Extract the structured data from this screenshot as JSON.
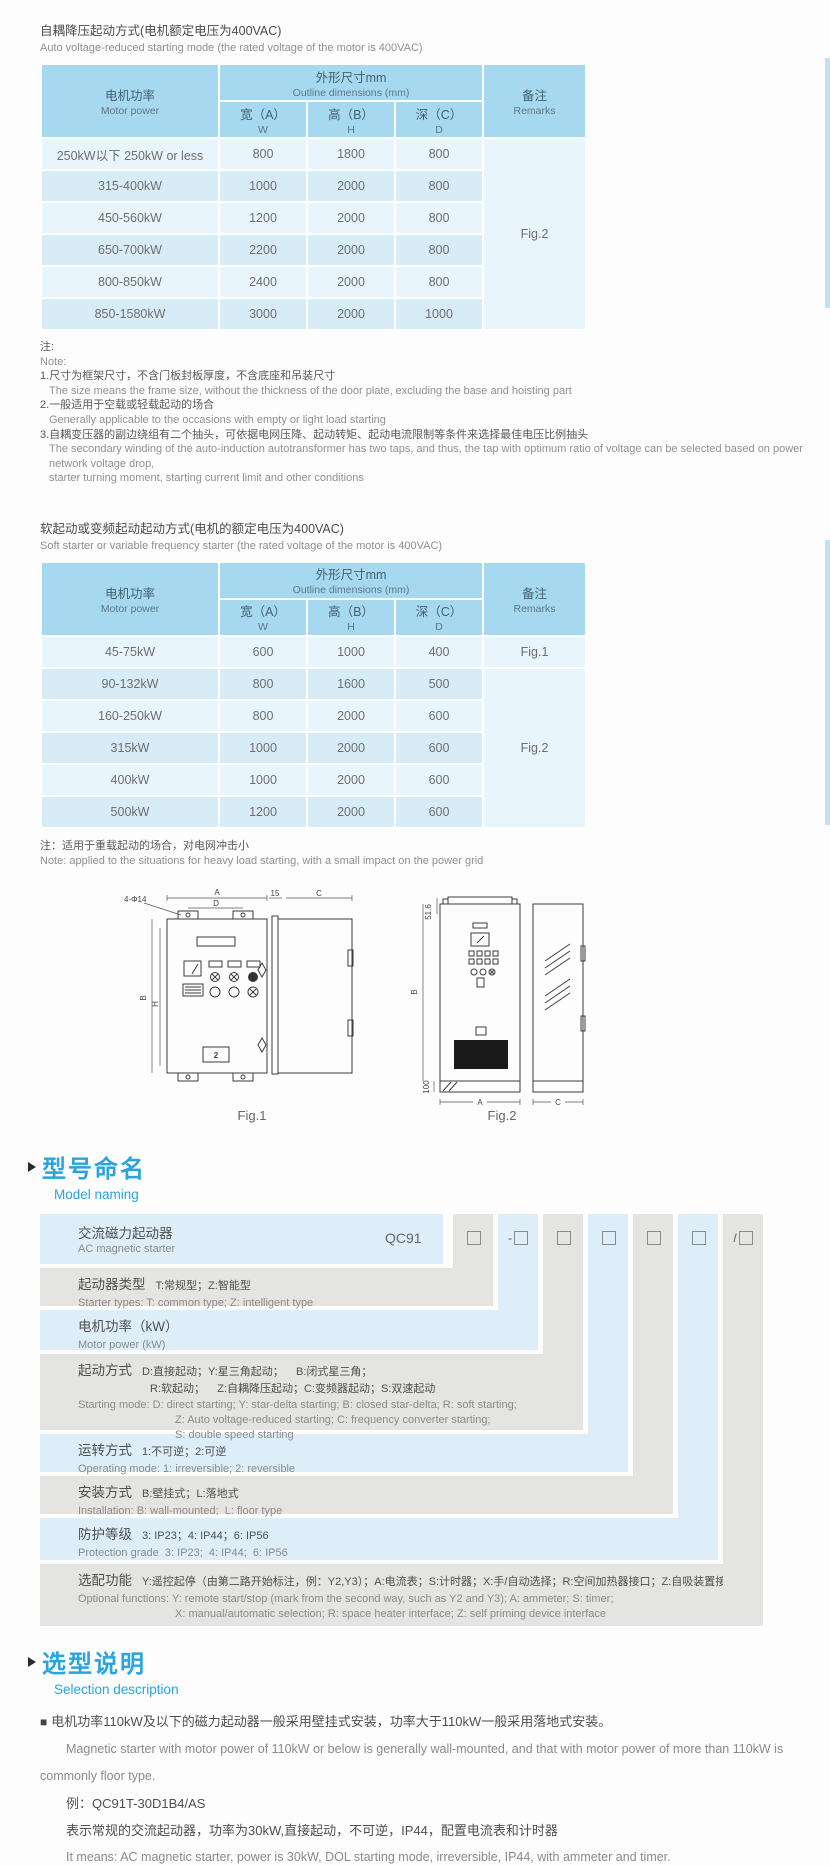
{
  "table_header": {
    "motor_cn": "电机功率",
    "motor_en": "Motor power",
    "outline_cn": "外形尺寸mm",
    "outline_en": "Outline dimensions (mm)",
    "w_cn": "宽（A）",
    "w_en": "W",
    "h_cn": "高（B）",
    "h_en": "H",
    "d_cn": "深（C）",
    "d_en": "D",
    "remarks_cn": "备注",
    "remarks_en": "Remarks"
  },
  "section_auto": {
    "title_cn": "自耦降压起动方式(电机额定电压为400VAC)",
    "title_en": "Auto voltage-reduced starting mode (the rated voltage of the motor is 400VAC)",
    "table": {
      "rows": [
        {
          "power": "250kW以下 250kW or less",
          "w": "800",
          "h": "1800",
          "d": "800"
        },
        {
          "power": "315-400kW",
          "w": "1000",
          "h": "2000",
          "d": "800"
        },
        {
          "power": "450-560kW",
          "w": "1200",
          "h": "2000",
          "d": "800"
        },
        {
          "power": "650-700kW",
          "w": "2200",
          "h": "2000",
          "d": "800"
        },
        {
          "power": "800-850kW",
          "w": "2400",
          "h": "2000",
          "d": "800"
        },
        {
          "power": "850-1580kW",
          "w": "3000",
          "h": "2000",
          "d": "1000"
        }
      ],
      "remark": "Fig.2"
    },
    "notes": [
      "注:",
      "Note:",
      "1.尺寸为框架尺寸，不含门板封板厚度，不含底座和吊装尺寸",
      "The size means the frame size, without the thickness of the door plate, excluding the base and hoisting part",
      "2.一般适用于空载或轻载起动的场合",
      "Generally applicable to the occasions with empty or light load starting",
      "3.自耦变压器的副边绕组有二个抽头，可依据电网压降、起动转矩、起动电流限制等条件来选择最佳电压比例抽头",
      "The secondary winding of the auto-induction autotransformer has two taps, and thus, the tap with optimum ratio of voltage can be selected based on power network voltage drop,",
      "starter turning moment, starting current limit and other conditions"
    ]
  },
  "section_soft": {
    "title_cn": "软起动或变频起动起动方式(电机的额定电压为400VAC)",
    "title_en": "Soft starter or variable frequency starter (the rated voltage of the motor is 400VAC)",
    "table": {
      "rows": [
        {
          "power": "45-75kW",
          "w": "600",
          "h": "1000",
          "d": "400"
        },
        {
          "power": "90-132kW",
          "w": "800",
          "h": "1600",
          "d": "500"
        },
        {
          "power": "160-250kW",
          "w": "800",
          "h": "2000",
          "d": "600"
        },
        {
          "power": "315kW",
          "w": "1000",
          "h": "2000",
          "d": "600"
        },
        {
          "power": "400kW",
          "w": "1000",
          "h": "2000",
          "d": "600"
        },
        {
          "power": "500kW",
          "w": "1200",
          "h": "2000",
          "d": "600"
        }
      ],
      "remark_first": "Fig.1",
      "remark_rest": "Fig.2"
    },
    "note_cn": "注：适用于重载起动的场合，对电网冲击小",
    "note_en": "Note: applied to the situations for heavy load starting, with a small impact on the power grid"
  },
  "figures": {
    "fig1": {
      "caption": "Fig.1",
      "dim_a": "A",
      "dim_d": "D",
      "dim_b": "B",
      "dim_h": "H",
      "holes": "4-Φ14",
      "side_offset": "15",
      "side_depth": "C",
      "panel_num": "2"
    },
    "fig2": {
      "caption": "Fig.2",
      "dim_top": "51.6",
      "dim_b": "B",
      "dim_base": "100",
      "dim_a": "A",
      "dim_c": "C"
    }
  },
  "model_naming": {
    "heading_cn": "型号命名",
    "heading_en": "Model naming",
    "product_cn": "交流磁力起动器",
    "product_en": "AC magnetic starter",
    "code": "QC91",
    "boxes": [
      {
        "prefix": ""
      },
      {
        "prefix": "-"
      },
      {
        "prefix": ""
      },
      {
        "prefix": ""
      },
      {
        "prefix": ""
      },
      {
        "prefix": ""
      },
      {
        "prefix": "/"
      }
    ],
    "rows": [
      {
        "label": "起动器类型",
        "cn": "T:常规型；Z:智能型",
        "en1": "Starter types: T: common type; Z: intelligent type"
      },
      {
        "label": "电机功率（kW）",
        "en1": "Motor power (kW)"
      },
      {
        "label": "起动方式",
        "cn": "D:直接起动；Y:星三角起动；    B:闭式星三角；",
        "cn2": "R:软起动；    Z:自耦降压起动；C:变频器起动；S:双速起动",
        "en1": "Starting mode: D: direct starting; Y: star-delta starting; B: closed star-delta; R: soft starting;",
        "en2": "Z: Auto voltage-reduced starting; C: frequency converter starting;",
        "en3": "S: double speed starting"
      },
      {
        "label": "运转方式",
        "cn": "1:不可逆；2:可逆",
        "en1": "Operating mode: 1: irreversible; 2: reversible"
      },
      {
        "label": "安装方式",
        "cn": "B:壁挂式；L:落地式",
        "en1": "Installation: B: wall-mounted;  L: floor type"
      },
      {
        "label": "防护等级",
        "cn": "3: IP23；4: IP44；6: IP56",
        "en1": "Protection grade  3: IP23;  4: IP44;  6: IP56"
      },
      {
        "label": "选配功能",
        "cn": "Y:遥控起停（由第二路开始标注，例：Y2,Y3）；A:电流表；S:计时器；X:手/自动选择；R:空间加热器接口；Z:自吸装置接口",
        "en1": "Optional functions: Y: remote start/stop (mark from the second way, such as Y2 and Y3); A: ammeter; S: timer;",
        "en2": "X: manual/automatic selection; R: space heater interface; Z: self priming device interface"
      }
    ]
  },
  "selection": {
    "heading_cn": "选型说明",
    "heading_en": "Selection description",
    "bullet": "■",
    "line1_cn": "电机功率110kW及以下的磁力起动器一般采用壁挂式安装，功率大于110kW一般采用落地式安装。",
    "line1_en_a": "Magnetic starter with motor power of 110kW or below is generally wall-mounted, and that with motor power of more than 110kW is",
    "line1_en_b": "commonly floor type.",
    "example": "例：QC91T-30D1B4/AS",
    "example_cn": "表示常规的交流起动器，功率为30kW,直接起动，不可逆，IP44，配置电流表和计时器",
    "example_en": "It means: AC magnetic starter, power is 30kW, DOL starting mode, irreversible, IP44, with ammeter and timer."
  }
}
